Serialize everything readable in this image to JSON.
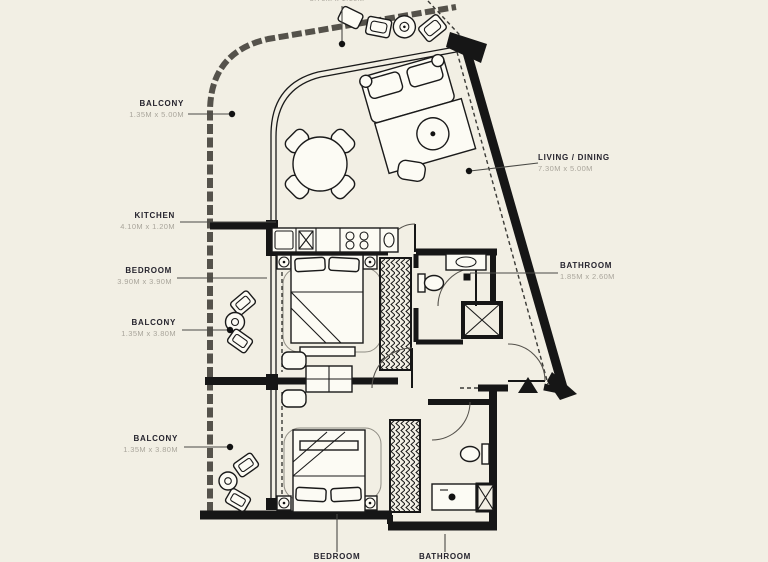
{
  "title": "Apartment floor plan",
  "colors": {
    "background": "#f2efe4",
    "wall": "#161616",
    "outer": "#55524b",
    "label": "#26242e",
    "dims": "#a9a59b"
  },
  "labels": {
    "balconyTop": {
      "name": "",
      "dims": "3.70M x 1.10M"
    },
    "balcony1": {
      "name": "BALCONY",
      "dims": "1.35M x 5.00M"
    },
    "kitchen": {
      "name": "KITCHEN",
      "dims": "4.10M x 1.20M"
    },
    "bedroom1": {
      "name": "BEDROOM",
      "dims": "3.90M x 3.90M"
    },
    "balcony2": {
      "name": "BALCONY",
      "dims": "1.35M x 3.80M"
    },
    "balcony3": {
      "name": "BALCONY",
      "dims": "1.35M x 3.80M"
    },
    "livingDining": {
      "name": "LIVING / DINING",
      "dims": "7.30M x 5.00M"
    },
    "bathroom1": {
      "name": "BATHROOM",
      "dims": "1.85M x 2.60M"
    },
    "bedroom2": {
      "name": "BEDROOM",
      "dims": ""
    },
    "bathroom2": {
      "name": "BATHROOM",
      "dims": ""
    }
  }
}
